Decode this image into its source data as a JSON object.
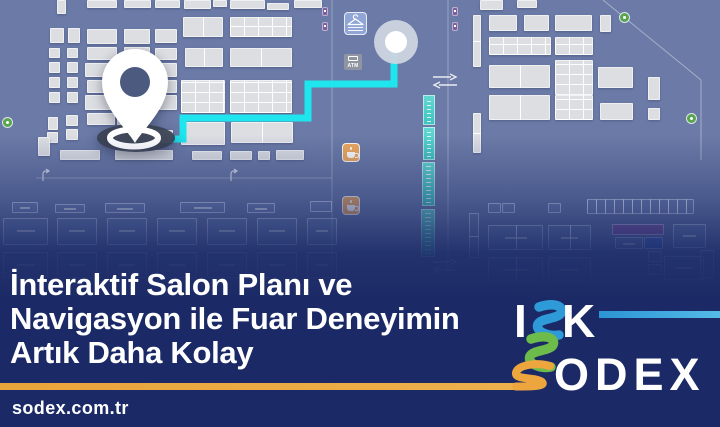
{
  "banner": {
    "headline": [
      "İnteraktif Salon Planı ve",
      "Navigasyon ile Fuar Deneyimin",
      "Artık Daha Kolay"
    ],
    "url": "sodex.com.tr"
  },
  "logo": {
    "i": "I",
    "k": "K",
    "odex": "ODEX"
  },
  "colors": {
    "map_bg": "#6b7aa6",
    "booth": "#dcdee2",
    "band_navy": "#1b2a66",
    "route_cyan": "#1fe5ee",
    "gold": "#eaa53c",
    "teal": "#4ecdc9",
    "logo_blue": "#2e9ad8",
    "logo_green": "#6dbb4a",
    "logo_orange": "#eda63e",
    "cafe_orange": "#f0a95e",
    "coat_check_blue": "#8fa6d6",
    "info_green": "#58a74e"
  },
  "map": {
    "atm_label": "ATM",
    "icons": [
      "location-pin",
      "destination-circle",
      "hanger-coat-check",
      "atm",
      "coffee-cup",
      "escalator-strip",
      "transfer-arrows",
      "info-dot",
      "column-marker",
      "door-arrow"
    ],
    "route": {
      "points": "172,139 183,139 183,118 308,118 308,84 394,84 394,50"
    },
    "booths": [
      [
        57,
        0,
        9,
        14
      ],
      [
        87,
        0,
        30,
        8
      ],
      [
        124,
        0,
        27,
        8
      ],
      [
        155,
        0,
        25,
        8
      ],
      [
        184,
        0,
        27,
        9
      ],
      [
        213,
        0,
        14,
        7
      ],
      [
        230,
        0,
        35,
        9
      ],
      [
        267,
        3,
        22,
        7
      ],
      [
        294,
        0,
        28,
        8
      ],
      [
        480,
        0,
        23,
        10
      ],
      [
        517,
        0,
        20,
        8
      ],
      [
        50,
        28,
        14,
        15
      ],
      [
        68,
        28,
        12,
        15
      ],
      [
        49,
        48,
        11,
        10
      ],
      [
        67,
        48,
        11,
        10
      ],
      [
        49,
        62,
        11,
        11
      ],
      [
        67,
        62,
        11,
        11
      ],
      [
        49,
        77,
        11,
        11
      ],
      [
        67,
        77,
        11,
        11
      ],
      [
        49,
        92,
        11,
        11
      ],
      [
        67,
        92,
        11,
        11
      ],
      [
        48,
        117,
        10,
        13
      ],
      [
        66,
        115,
        12,
        11
      ],
      [
        47,
        132,
        11,
        11
      ],
      [
        66,
        129,
        12,
        11
      ],
      [
        38,
        137,
        12,
        19
      ],
      [
        87,
        29,
        30,
        15
      ],
      [
        87,
        47,
        30,
        13
      ],
      [
        85,
        63,
        32,
        14
      ],
      [
        87,
        80,
        30,
        13
      ],
      [
        85,
        95,
        32,
        15
      ],
      [
        87,
        113,
        28,
        12
      ],
      [
        124,
        29,
        26,
        15
      ],
      [
        124,
        47,
        26,
        13
      ],
      [
        124,
        63,
        26,
        14
      ],
      [
        124,
        80,
        26,
        13
      ],
      [
        124,
        95,
        26,
        15
      ],
      [
        155,
        29,
        22,
        14
      ],
      [
        155,
        48,
        22,
        12
      ],
      [
        155,
        63,
        22,
        14
      ],
      [
        155,
        80,
        22,
        13
      ],
      [
        155,
        95,
        22,
        15
      ],
      [
        117,
        113,
        26,
        12
      ],
      [
        115,
        130,
        58,
        13
      ],
      [
        60,
        150,
        40,
        10
      ],
      [
        115,
        150,
        58,
        10
      ],
      [
        192,
        151,
        30,
        9
      ],
      [
        230,
        151,
        22,
        9
      ],
      [
        258,
        151,
        12,
        9
      ],
      [
        276,
        150,
        28,
        10
      ],
      [
        183,
        17,
        40,
        20,
        "v"
      ],
      [
        185,
        48,
        38,
        19,
        "v"
      ],
      [
        181,
        80,
        44,
        33,
        "g"
      ],
      [
        181,
        122,
        44,
        23
      ],
      [
        230,
        17,
        62,
        20,
        "g"
      ],
      [
        230,
        48,
        62,
        19,
        "v"
      ],
      [
        230,
        80,
        62,
        33,
        "g"
      ],
      [
        231,
        122,
        62,
        21,
        "v"
      ],
      [
        473,
        15,
        8,
        52,
        "h"
      ],
      [
        473,
        113,
        8,
        40,
        "h"
      ],
      [
        489,
        15,
        28,
        16
      ],
      [
        524,
        15,
        25,
        16
      ],
      [
        555,
        15,
        37,
        16
      ],
      [
        600,
        15,
        11,
        17
      ],
      [
        489,
        37,
        62,
        18,
        "g"
      ],
      [
        555,
        37,
        38,
        18,
        "g"
      ],
      [
        489,
        65,
        61,
        23,
        "v"
      ],
      [
        555,
        60,
        38,
        35,
        "g"
      ],
      [
        598,
        67,
        35,
        21
      ],
      [
        489,
        95,
        61,
        25,
        "v"
      ],
      [
        555,
        95,
        38,
        25,
        "g"
      ],
      [
        600,
        103,
        33,
        17
      ],
      [
        648,
        77,
        12,
        23
      ],
      [
        648,
        108,
        12,
        12
      ]
    ],
    "ghost_booths": [
      [
        12,
        202,
        26,
        11
      ],
      [
        55,
        204,
        30,
        9
      ],
      [
        105,
        203,
        40,
        10
      ],
      [
        180,
        202,
        45,
        11
      ],
      [
        247,
        203,
        28,
        10
      ],
      [
        310,
        201,
        22,
        11
      ],
      [
        3,
        218,
        45,
        27
      ],
      [
        57,
        218,
        40,
        27
      ],
      [
        107,
        218,
        40,
        27
      ],
      [
        157,
        218,
        40,
        27
      ],
      [
        207,
        218,
        40,
        27
      ],
      [
        257,
        218,
        40,
        27
      ],
      [
        307,
        218,
        30,
        27
      ],
      [
        3,
        252,
        45,
        26
      ],
      [
        57,
        252,
        40,
        26
      ],
      [
        107,
        252,
        40,
        26
      ],
      [
        157,
        252,
        40,
        26
      ],
      [
        207,
        252,
        40,
        26
      ],
      [
        257,
        252,
        40,
        26
      ],
      [
        307,
        252,
        30,
        26
      ],
      [
        488,
        203,
        13,
        10
      ],
      [
        502,
        203,
        13,
        10
      ],
      [
        548,
        203,
        13,
        10
      ],
      [
        587,
        199,
        107,
        15,
        "c"
      ],
      [
        469,
        213,
        10,
        45,
        "h"
      ],
      [
        488,
        225,
        55,
        25,
        "v"
      ],
      [
        548,
        225,
        43,
        25,
        "v"
      ],
      [
        612,
        224,
        52,
        11,
        "purple"
      ],
      [
        615,
        237,
        28,
        12
      ],
      [
        644,
        237,
        19,
        12,
        "blue"
      ],
      [
        673,
        224,
        33,
        24
      ],
      [
        488,
        257,
        55,
        25,
        "v"
      ],
      [
        548,
        257,
        43,
        25
      ],
      [
        648,
        251,
        14,
        11
      ],
      [
        648,
        264,
        14,
        11
      ],
      [
        664,
        256,
        40,
        24
      ],
      [
        700,
        250,
        14,
        28
      ]
    ],
    "teal_segments": [
      [
        423,
        95,
        12,
        30
      ],
      [
        423,
        127,
        12,
        33
      ],
      [
        422,
        162,
        13,
        44
      ],
      [
        421,
        209,
        14,
        48
      ]
    ]
  }
}
